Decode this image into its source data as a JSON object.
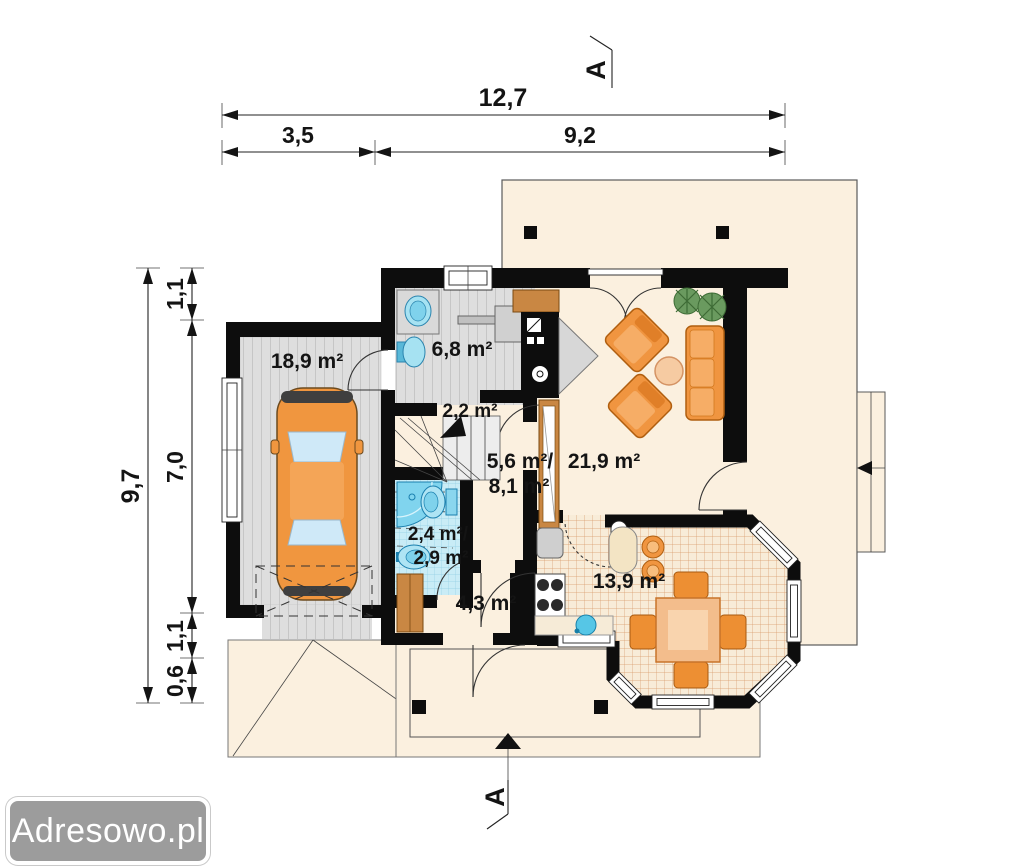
{
  "watermark": {
    "label": "Adresowo.pl"
  },
  "section_marker": {
    "top": "A",
    "bottom": "A"
  },
  "dimensions": {
    "total_width": "12,7",
    "width_garage": "3,5",
    "width_main": "9,2",
    "total_depth": "9,7",
    "depth_top": "1,1",
    "depth_mid": "7,0",
    "depth_lower": "1,1",
    "depth_bottom": "0,6"
  },
  "rooms": {
    "garage": "18,9 m²",
    "utility": "6,8 m²",
    "stairs": "2,2 m²",
    "hall_line1": "5,6 m²/",
    "hall_line2": "8,1 m²",
    "bath_line1": "2,4 m²/",
    "bath_line2": "2,9 m²",
    "vestibule": "4,3 m²",
    "living": "21,9 m²",
    "kitchen": "13,9 m²"
  },
  "colors": {
    "wall": "#0d0d0d",
    "floor_cream": "#fbf0df",
    "floor_gray": "#dedede",
    "tile_blue": "#c9ecf6",
    "tile_kitchen_line": "#d89a6a",
    "furniture_orange": "#f09540",
    "wood": "#c98743",
    "fixture_blue": "#a6e2f2"
  }
}
